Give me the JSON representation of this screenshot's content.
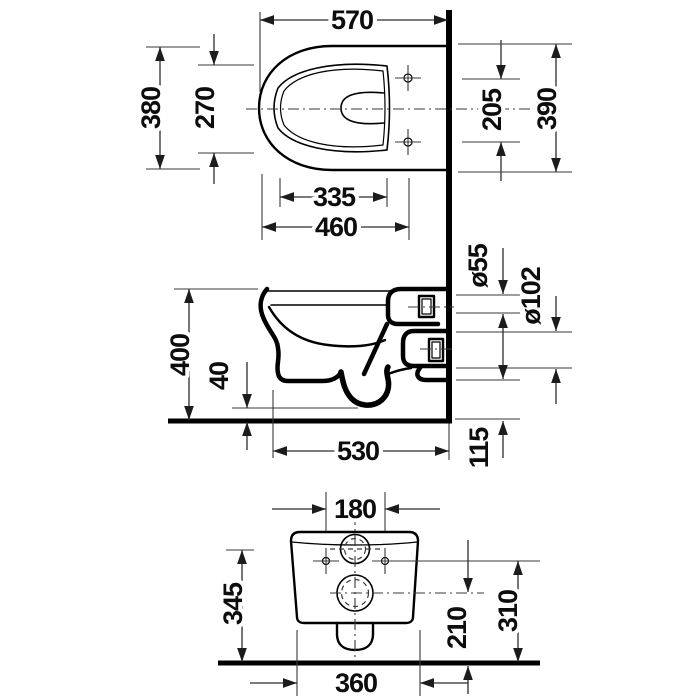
{
  "drawing": {
    "kind": "technical dimensional drawing",
    "subject": "wall-mounted toilet, three orthographic views",
    "units": "mm"
  },
  "colors": {
    "background": "#ffffff",
    "object_lines": "#000000",
    "dimension_lines": "#2c2c2c",
    "text": "#0d0d0d"
  },
  "views": {
    "plan": {
      "label": "top view",
      "dims": {
        "overall_length": "570",
        "overall_width": "380",
        "bowl_width": "270",
        "fixing_spacing": "205",
        "seat_width": "390",
        "bowl_length": "335",
        "front_to_fixings": "460"
      }
    },
    "side": {
      "label": "side section view",
      "dims": {
        "height": "400",
        "bottom_clearance": "40",
        "flush_pipe_dia": "ø55",
        "outlet_pipe_dia": "ø102",
        "projection": "530",
        "rear_bottom_height": "115"
      }
    },
    "rear": {
      "label": "rear view",
      "dims": {
        "connection_spacing": "180",
        "flush_conn_height": "345",
        "outlet_height": "210",
        "fixing_height": "310",
        "base_width": "360"
      }
    }
  }
}
